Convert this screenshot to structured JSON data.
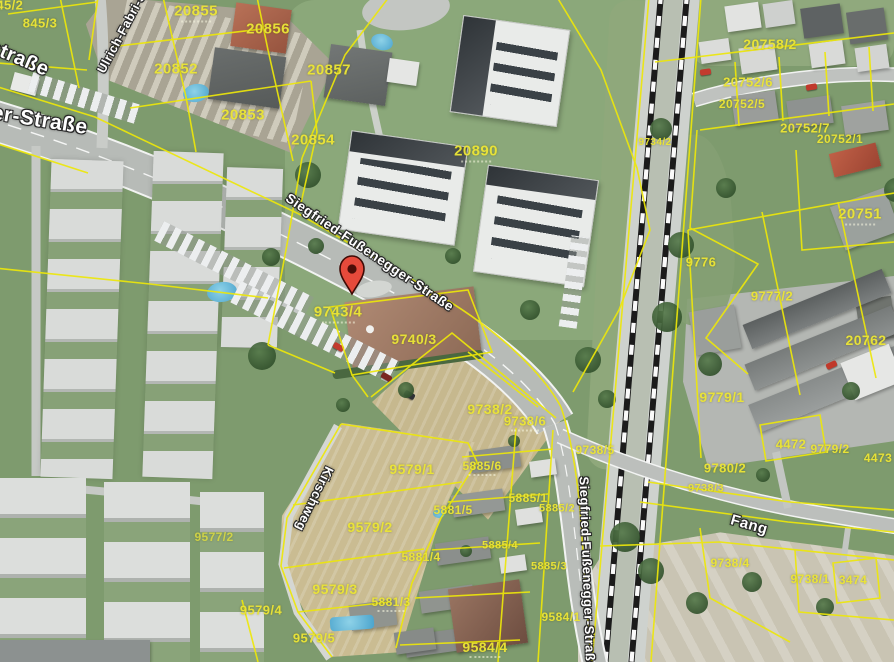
{
  "map": {
    "type": "aerial-cadastral-view",
    "colors": {
      "cadastral_line": "#ede70a",
      "parcel_label": "#ebe537",
      "street_label": "#ffffff",
      "marker": "#e64a3b"
    },
    "parcel_labels": [
      "845/2",
      "845/3",
      "20855",
      "20856",
      "20852",
      "20857",
      "20853",
      "20854",
      "20890",
      "20758/2",
      "20752/6",
      "20752/5",
      "20752/7",
      "20752/1",
      "20751",
      "9776",
      "9777/2",
      "20762",
      "9779/1",
      "4472",
      "9779/2",
      "4473",
      "9780/2",
      "9738/3",
      "9734/2",
      "9743/4",
      "9740/3",
      "9738/2",
      "9738/6",
      "9738/5",
      "9579/1",
      "9579/2",
      "9579/3",
      "9579/4",
      "9579/5",
      "9577/2",
      "5885/6",
      "5885/1",
      "5885/2",
      "5885/4",
      "5885/3",
      "5881/5",
      "5881/4",
      "5881/3",
      "9584/1",
      "9584/4",
      "9738/4",
      "9738/1",
      "3474"
    ],
    "street_labels": [
      "straße",
      "er-Straße",
      "Ulrich-Fabri-S",
      "Siegfried-Fußenegger-Straße",
      "Kirschweg",
      "Siegfried-Fußenegger-Straße",
      "Fang"
    ],
    "marker": {
      "shape": "map-pin",
      "fill": "#e64a3b",
      "outline": "#3f0b06"
    }
  }
}
